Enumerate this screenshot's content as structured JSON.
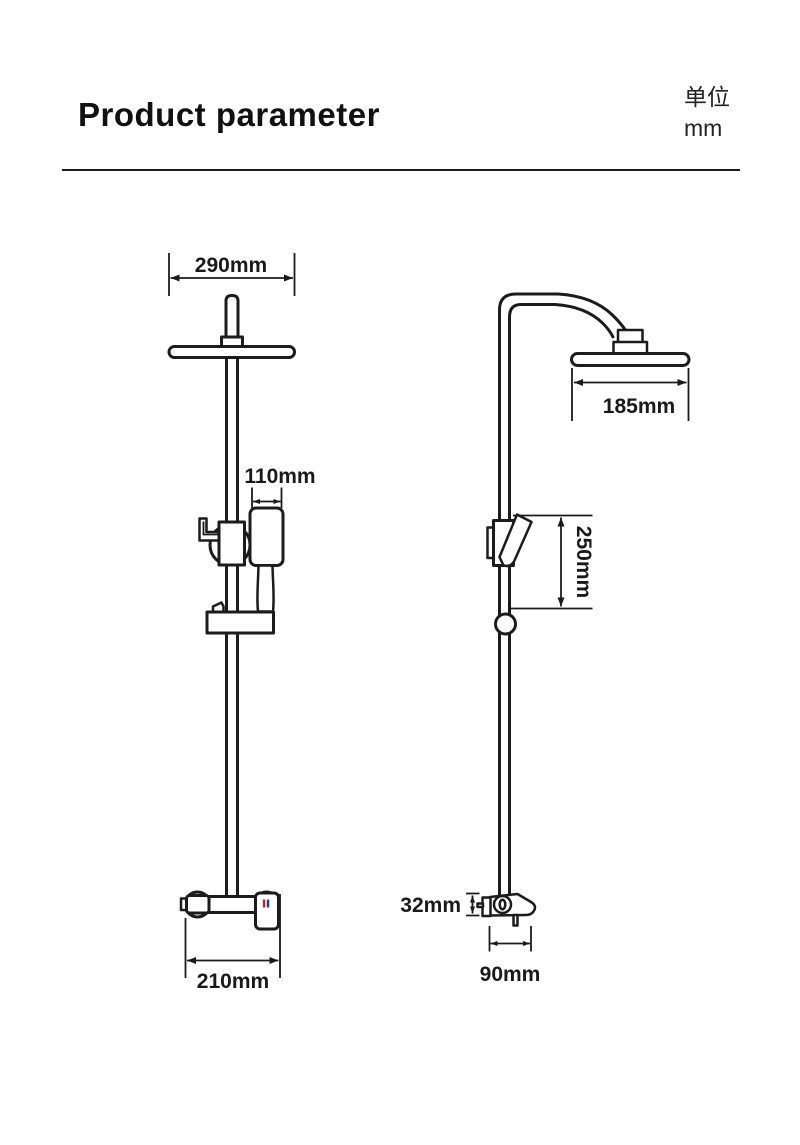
{
  "header": {
    "title": "Product parameter",
    "unit_label": "单位",
    "unit_value": "mm"
  },
  "dimensions": {
    "front": {
      "head_width": "290mm",
      "handshower_width": "110mm",
      "valve_width": "210mm"
    },
    "side": {
      "head_depth": "185mm",
      "rail_span": "250mm",
      "valve_height": "32mm",
      "valve_depth": "90mm"
    }
  },
  "colors": {
    "line": "#1c1c1c",
    "hot": "#c22a20",
    "cold": "#2732b6"
  }
}
